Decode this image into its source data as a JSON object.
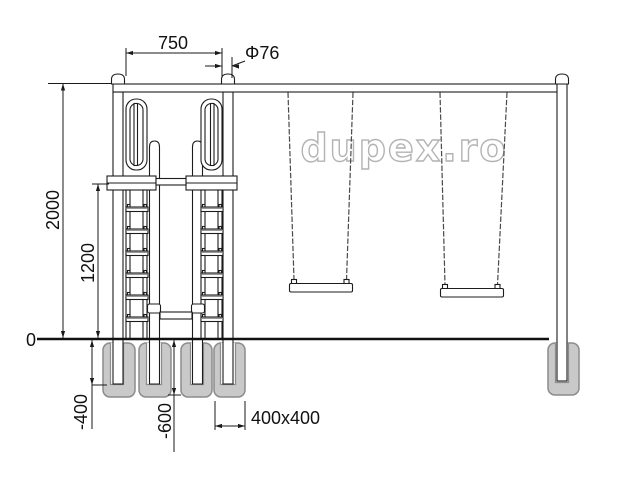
{
  "watermark": {
    "text": "dupex.ro"
  },
  "dimensions": {
    "top_width": "750",
    "pipe_diameter": "Φ76",
    "total_height": "2000",
    "ladder_height": "1200",
    "ground_level": "0",
    "post_depth": "-400",
    "foundation_depth": "-600",
    "foundation_size": "400x400"
  },
  "colors": {
    "line": "#1c1c1c",
    "dim": "#1a1a1a",
    "foundation_fill": "#c9c9c9",
    "foundation_stroke": "#8c8c8c",
    "watermark": "#b3b3b3",
    "chain": "#4a4a4a",
    "ground": "#111111"
  }
}
